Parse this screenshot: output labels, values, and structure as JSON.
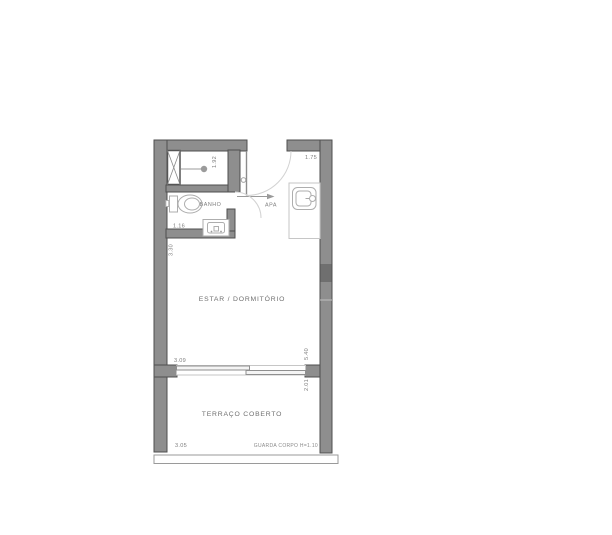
{
  "plan": {
    "rooms": {
      "banho_label": "BANHO",
      "apa_label": "APA",
      "estar_label": "ESTAR / DORMITÓRIO",
      "terraco_label": "TERRAÇO COBERTO"
    },
    "notes": {
      "guarda_corpo": "GUARDA CORPO H=1.10"
    },
    "dimensions": {
      "shower_depth": "1.92",
      "entry_width": "1.75",
      "banho_width": "1.16",
      "estar_upper_height": "3.30",
      "estar_width": "3.09",
      "right_side_height": "5.40",
      "terraco_height": "2.01",
      "terraco_width": "3.05"
    },
    "colors": {
      "wall_fill": "#8e8e8e",
      "wall_dark_band": "#6f6f6f",
      "fixture_line": "#aeaeae",
      "dim_text": "#7d7d7d"
    }
  }
}
